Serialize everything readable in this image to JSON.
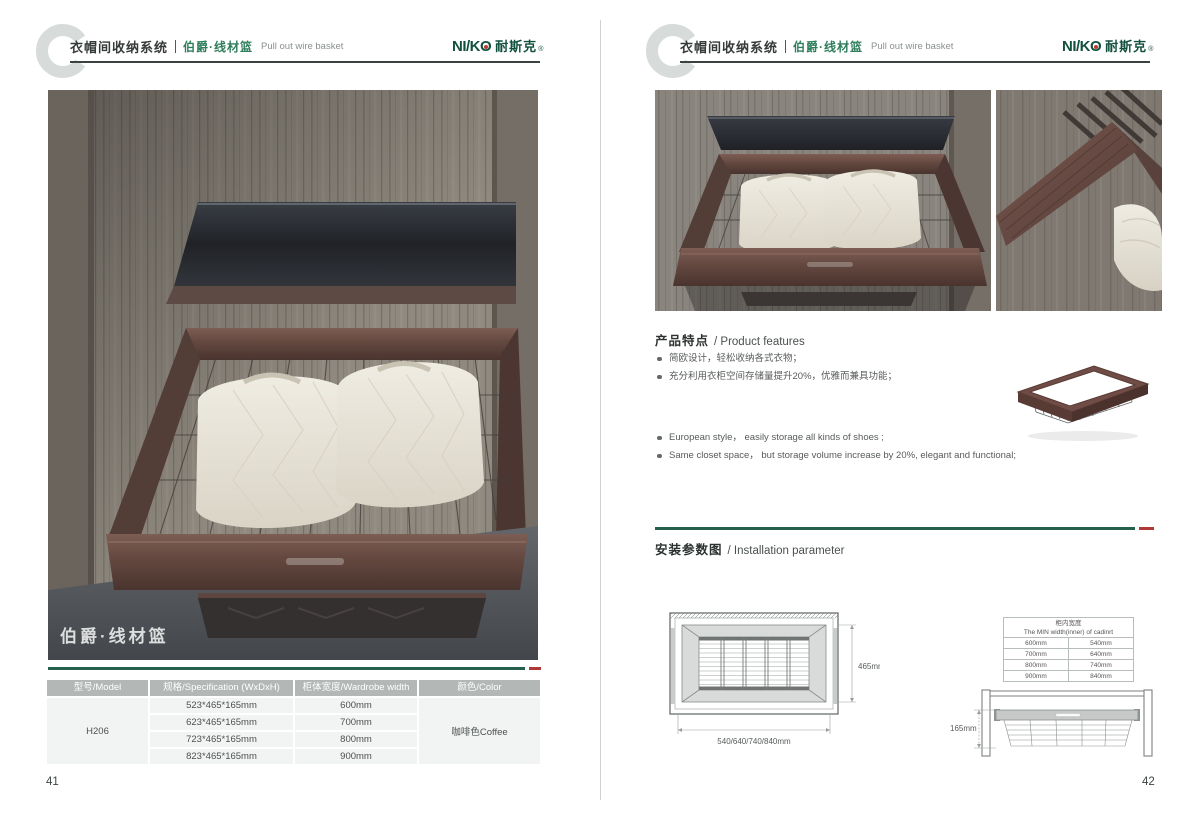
{
  "logo": {
    "en_prefix": "NI/K",
    "o": "O",
    "cn": "耐斯克",
    "reg": "®"
  },
  "header": {
    "system_cn": "衣帽间收纳系统",
    "product_cn": "伯爵·线材篮",
    "product_en": "Pull out wire basket"
  },
  "left_page": {
    "page_number": "41",
    "photo_caption": "伯爵·线材篮",
    "spec_table": {
      "headers": [
        "型号/Model",
        "规格/Specification (WxDxH)",
        "柜体宽度/Wardrobe width",
        "颜色/Color"
      ],
      "model": "H206",
      "color": "咖啡色Coffee",
      "rows": [
        {
          "spec": "523*465*165mm",
          "width": "600mm"
        },
        {
          "spec": "623*465*165mm",
          "width": "700mm"
        },
        {
          "spec": "723*465*165mm",
          "width": "800mm"
        },
        {
          "spec": "823*465*165mm",
          "width": "900mm"
        }
      ]
    }
  },
  "right_page": {
    "page_number": "42",
    "features": {
      "title_cn": "产品特点",
      "title_en": "/ Product features",
      "bullets_cn": [
        "简欧设计，轻松收纳各式衣物；",
        "充分利用衣柜空间存储量提升20%，优雅而兼具功能；"
      ],
      "bullets_en": [
        "European style， easily storage all kinds of shoes ;",
        "Same closet space， but storage volume increase by 20%, elegant and functional;"
      ]
    },
    "installation": {
      "title_cn": "安装参数图",
      "title_en": "/ Installation parameter",
      "top_view": {
        "width_label": "540/640/740/840mm",
        "depth_label": "465mm"
      },
      "min_width_table": {
        "title_cn": "柜内宽度",
        "title_en": "The MIN width(inner) of cadinrt",
        "rows": [
          [
            "600mm",
            "540mm"
          ],
          [
            "700mm",
            "640mm"
          ],
          [
            "800mm",
            "740mm"
          ],
          [
            "900mm",
            "840mm"
          ]
        ]
      },
      "side_view": {
        "height_label": "165mm"
      }
    }
  },
  "colors": {
    "brand_green": "#12503e",
    "divider_green": "#26604b",
    "accent_red": "#b03a33",
    "table_header_gray": "#b3b7b6",
    "coffee_frame": "#5e4640",
    "wood": "#8f897f"
  }
}
